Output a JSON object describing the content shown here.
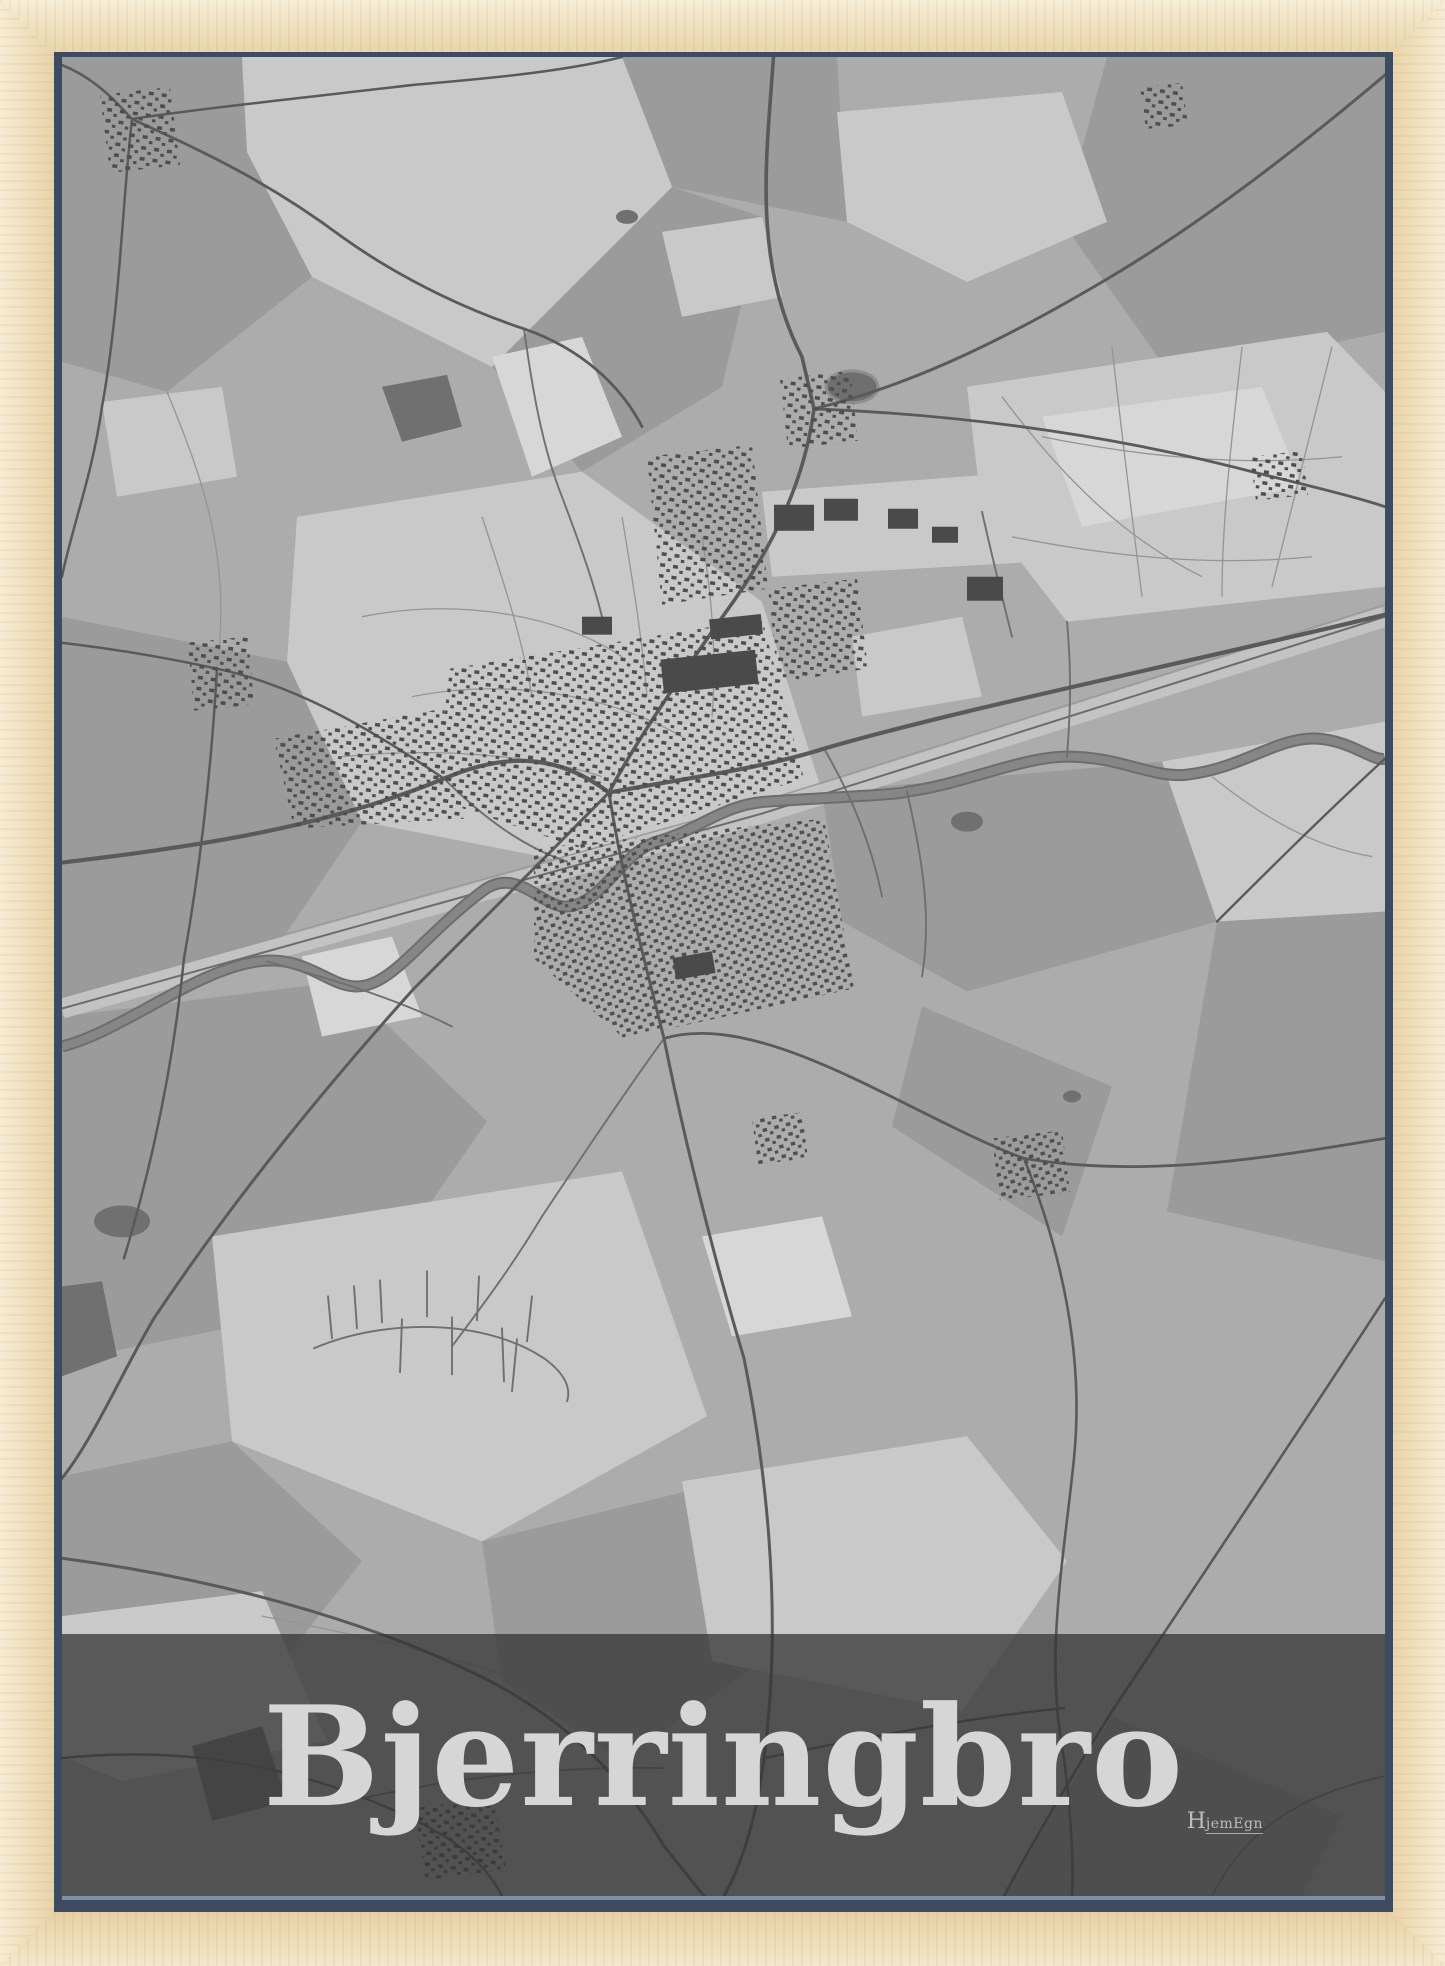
{
  "poster": {
    "title": "Bjerringbro",
    "brand_initial": "H",
    "brand_rest": "jemEgn"
  },
  "colors": {
    "frame_wood": "#efdcb8",
    "rabbet_shadow": "#3d4b61",
    "map_base": "#acacac",
    "map_light": "#c9c9c9",
    "map_lighter": "#d7d7d7",
    "map_medium": "#9b9b9b",
    "map_dark": "#707070",
    "road_major": "#5a5a5a",
    "road_minor": "#6f6f6f",
    "path_minor": "#949494",
    "river": "#868686",
    "railway_band": "#c3c3c3",
    "building": "#4e4e4e",
    "title_band": "rgba(54,54,54,0.76)",
    "title_text": "#d6d6d6"
  }
}
